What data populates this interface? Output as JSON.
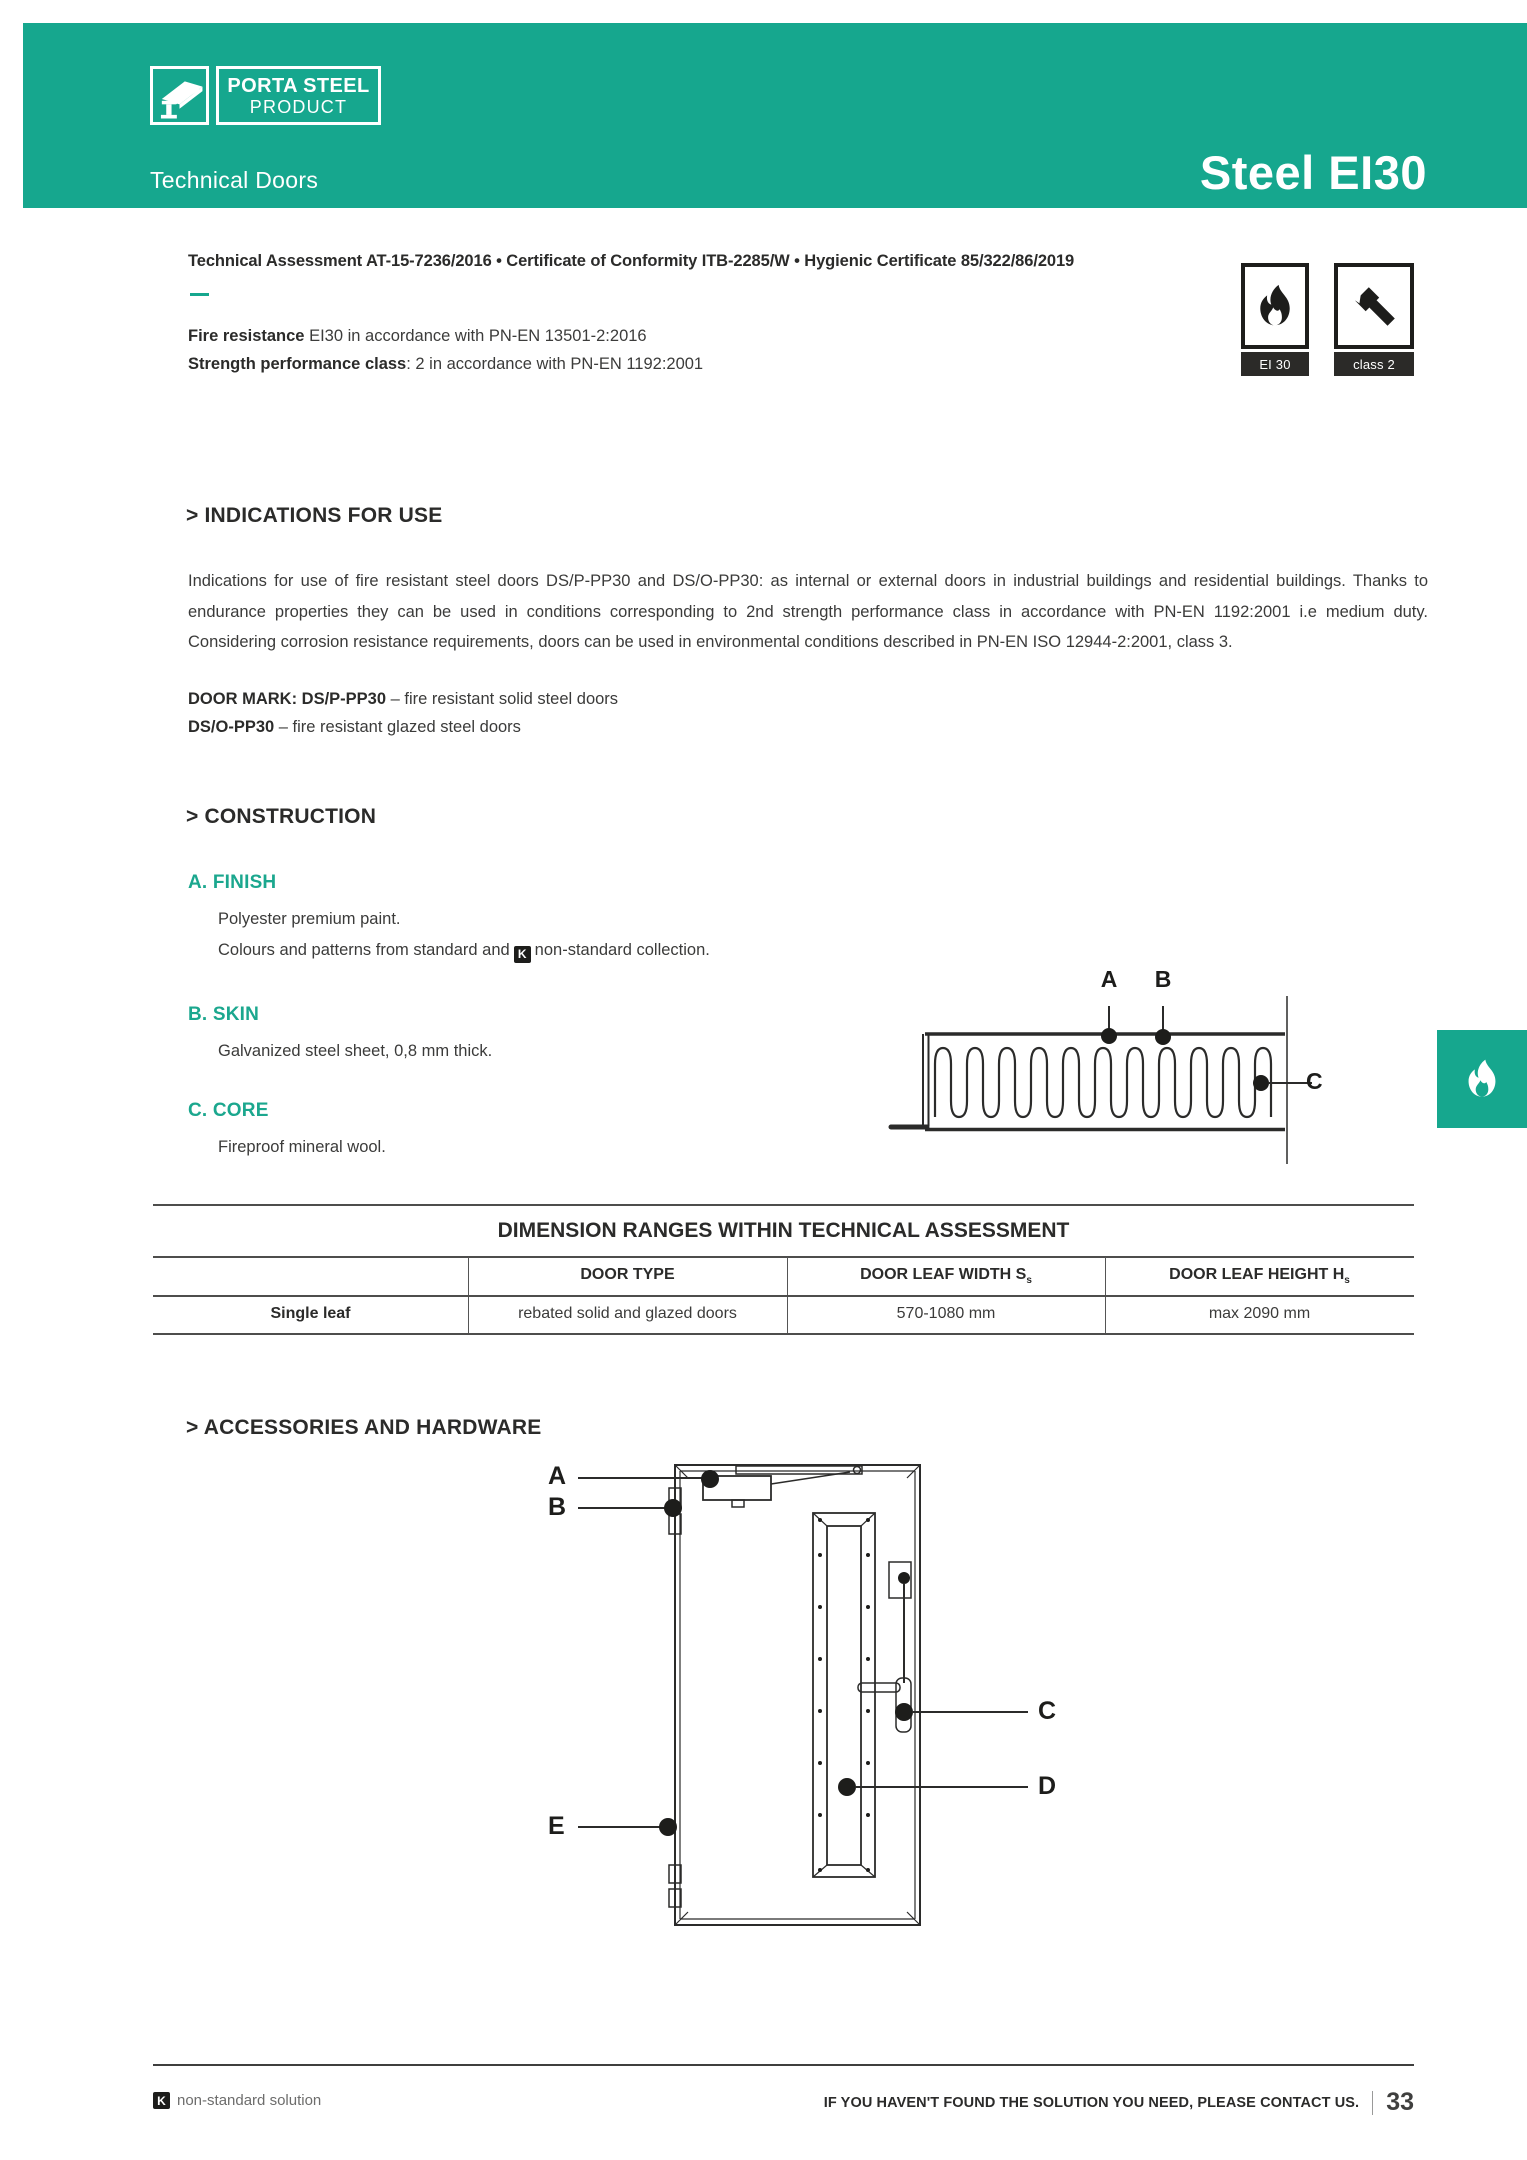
{
  "header": {
    "brand_top": "PORTA STEEL",
    "brand_bottom": "PRODUCT",
    "subtitle": "Technical Doors",
    "title": "Steel EI30",
    "accent_color": "#16a78e"
  },
  "certifications": {
    "line": "Technical Assessment AT-15-7236/2016 • Certificate of Conformity ITB-2285/W • Hygienic Certificate 85/322/86/2019",
    "fire_resistance_label": "Fire resistance",
    "fire_resistance_value": " EI30 in accordance with PN-EN 13501-2:2016",
    "strength_label": "Strength performance class",
    "strength_value": ": 2 in accordance with PN-EN 1192:2001",
    "badges": [
      {
        "icon": "fire-icon",
        "label": "EI 30"
      },
      {
        "icon": "hammer-icon",
        "label": "class 2"
      }
    ]
  },
  "indications": {
    "heading": "> INDICATIONS FOR USE",
    "paragraph": "Indications for use of fire resistant steel doors DS/P-PP30 and DS/O-PP30: as internal or external doors in industrial buildings and residential buildings. Thanks to endurance properties they can be used in conditions corresponding to 2nd strength performance class in accordance with PN-EN 1192:2001 i.e medium duty. Considering corrosion resistance requirements, doors can be used in environmental conditions described in PN-EN ISO 12944-2:2001, class 3.",
    "door_mark_bold": "DOOR MARK: DS/P-PP30",
    "door_mark_rest": " – fire resistant solid steel doors",
    "door_mark2_bold": "DS/O-PP30",
    "door_mark2_rest": " – fire resistant glazed steel doors"
  },
  "construction": {
    "heading": "> CONSTRUCTION",
    "finish_label": "A. FINISH",
    "finish_line1": "Polyester premium paint.",
    "finish_line2_prefix": "Colours and patterns from standard and",
    "finish_k": "K",
    "finish_line2_suffix": "non-standard collection.",
    "skin_label": "B. SKIN",
    "skin_line": "Galvanized steel sheet, 0,8 mm thick.",
    "core_label": "C. CORE",
    "core_line": "Fireproof mineral wool.",
    "diagram_labels": [
      "A",
      "B",
      "C"
    ]
  },
  "dimensions_table": {
    "title": "DIMENSION RANGES WITHIN TECHNICAL ASSESSMENT",
    "col_door_type": "DOOR TYPE",
    "col_width": "DOOR LEAF WIDTH S",
    "col_width_sub": "s",
    "col_height": "DOOR LEAF HEIGHT H",
    "col_height_sub": "s",
    "row_label": "Single leaf",
    "row_door_type": "rebated solid and glazed doors",
    "row_width": "570-1080 mm",
    "row_height": "max 2090 mm"
  },
  "accessories": {
    "heading": "> ACCESSORIES AND HARDWARE",
    "diagram_labels": [
      "A",
      "B",
      "C",
      "D",
      "E"
    ]
  },
  "footer": {
    "k_icon": "K",
    "left_text": "non-standard solution",
    "contact_text": "IF YOU HAVEN'T FOUND THE SOLUTION YOU NEED, PLEASE CONTACT US.",
    "page_number": "33"
  }
}
